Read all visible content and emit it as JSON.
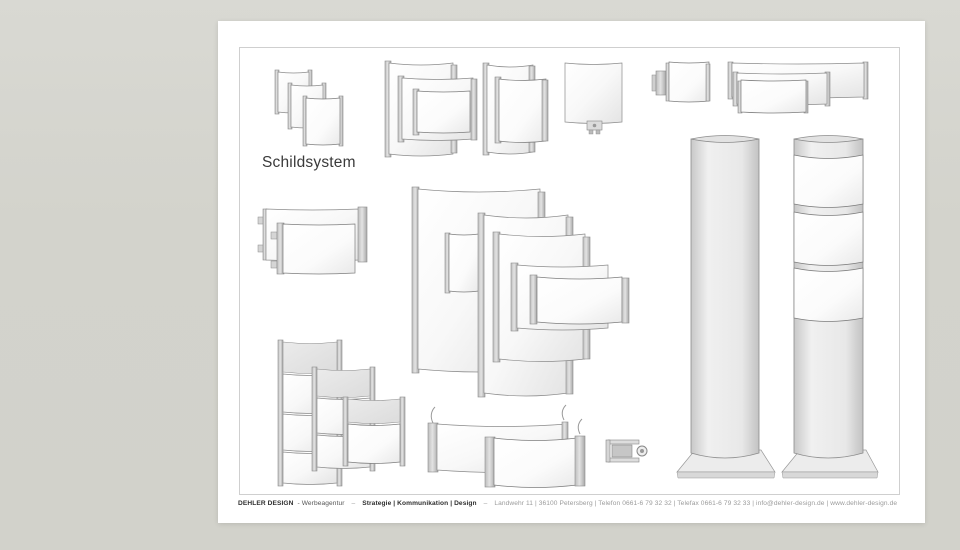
{
  "title": "Schildsystem",
  "footer": {
    "brand": "DEHLER DESIGN",
    "brand_suffix": "- Werbeagentur",
    "sep": "–",
    "tagline": "Strategie | Kommunikation | Design",
    "address": "Landwehr 11 | 36100 Petersberg | Telefon 0661-6 79 32 32 | Telefax 0661-6 79 32 33 | info@dehler-design.de | www.dehler-design.de"
  },
  "colors": {
    "background": "#d3d3cc",
    "page": "#ffffff",
    "frame_border": "#cfcfcf",
    "panel_stroke": "#8c8c8c",
    "title_text": "#3a3a3a",
    "footer_text": "#2e2e2e",
    "footer_muted": "#9b9b9b"
  },
  "illustrations": [
    "door-plates-set",
    "nested-wall-signs",
    "double-wall-sign",
    "single-panel-with-connector",
    "small-sign-with-bracket",
    "wide-layered-panels",
    "wall-sign-with-clips",
    "door-sign-cluster",
    "directory-towers",
    "desk-signs",
    "profile-cross-section",
    "pylon-column-plain",
    "pylon-column-banded"
  ]
}
